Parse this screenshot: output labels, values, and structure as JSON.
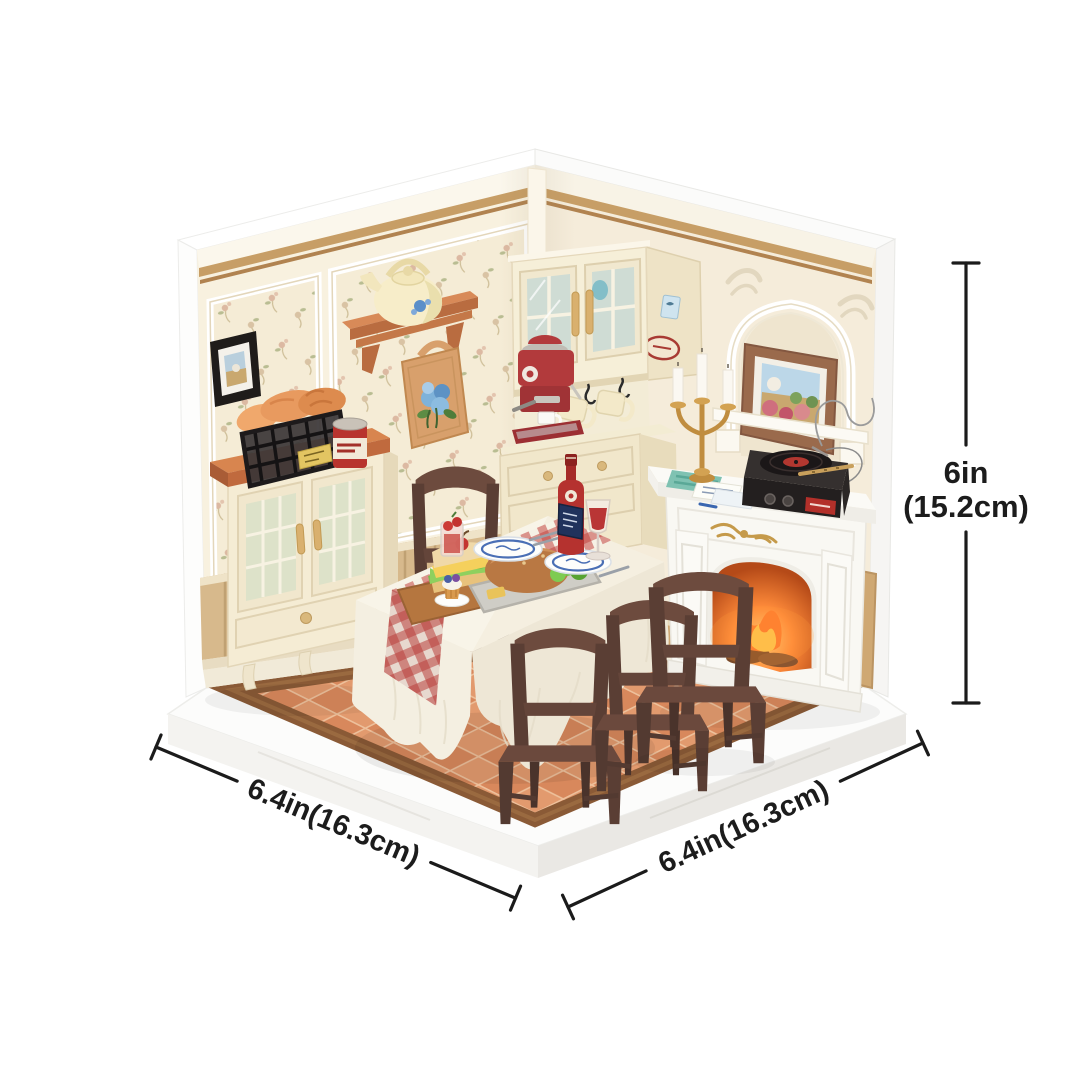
{
  "image": {
    "type": "product-dimension-diagram",
    "subject": "DIY miniature dollhouse dining-room corner kit with fireplace, dining table and cabinets"
  },
  "dimensions": {
    "height": {
      "value": "6in",
      "metric": "(15.2cm)"
    },
    "width_left": {
      "label": "6.4in(16.3cm)"
    },
    "width_right": {
      "label": "6.4in(16.3cm)"
    }
  },
  "colors": {
    "annotation": "#1c1c1c",
    "background": "#ffffff",
    "wall_cream": "#f7efdd",
    "wood_trim": "#c79e66",
    "wainscot_wood": "#d7b98c",
    "floor_tile_light": "#e29a6e",
    "floor_tile_dark": "#d8885c",
    "floor_border": "#8a5a36",
    "counter_top_terracotta": "#d8854f",
    "cabinet_cream": "#f5ecd4",
    "fireplace_white": "#fbfaf6",
    "chair_brown": "#5a3e34",
    "accent_red": "#b23a3c",
    "fire_orange": "#ff8b3a",
    "gold": "#c08d3f"
  },
  "scene": {
    "objects": [
      "base-platform",
      "tiled-floor",
      "left-wall",
      "right-wall",
      "display-cabinet",
      "bread-basket",
      "coffee-tin",
      "wall-art-frame",
      "wall-shelf",
      "tea-kettle",
      "tote-bag",
      "kitchen-cabinet-unit",
      "espresso-machine",
      "hanging-mugs",
      "counter-cabinet",
      "candelabra",
      "fireplace",
      "record-player",
      "arch-niche",
      "framed-painting",
      "dining-table",
      "gingham-runner",
      "dinner-plates",
      "food-tray",
      "wine-bottle",
      "wine-glass",
      "dining-chairs"
    ]
  }
}
